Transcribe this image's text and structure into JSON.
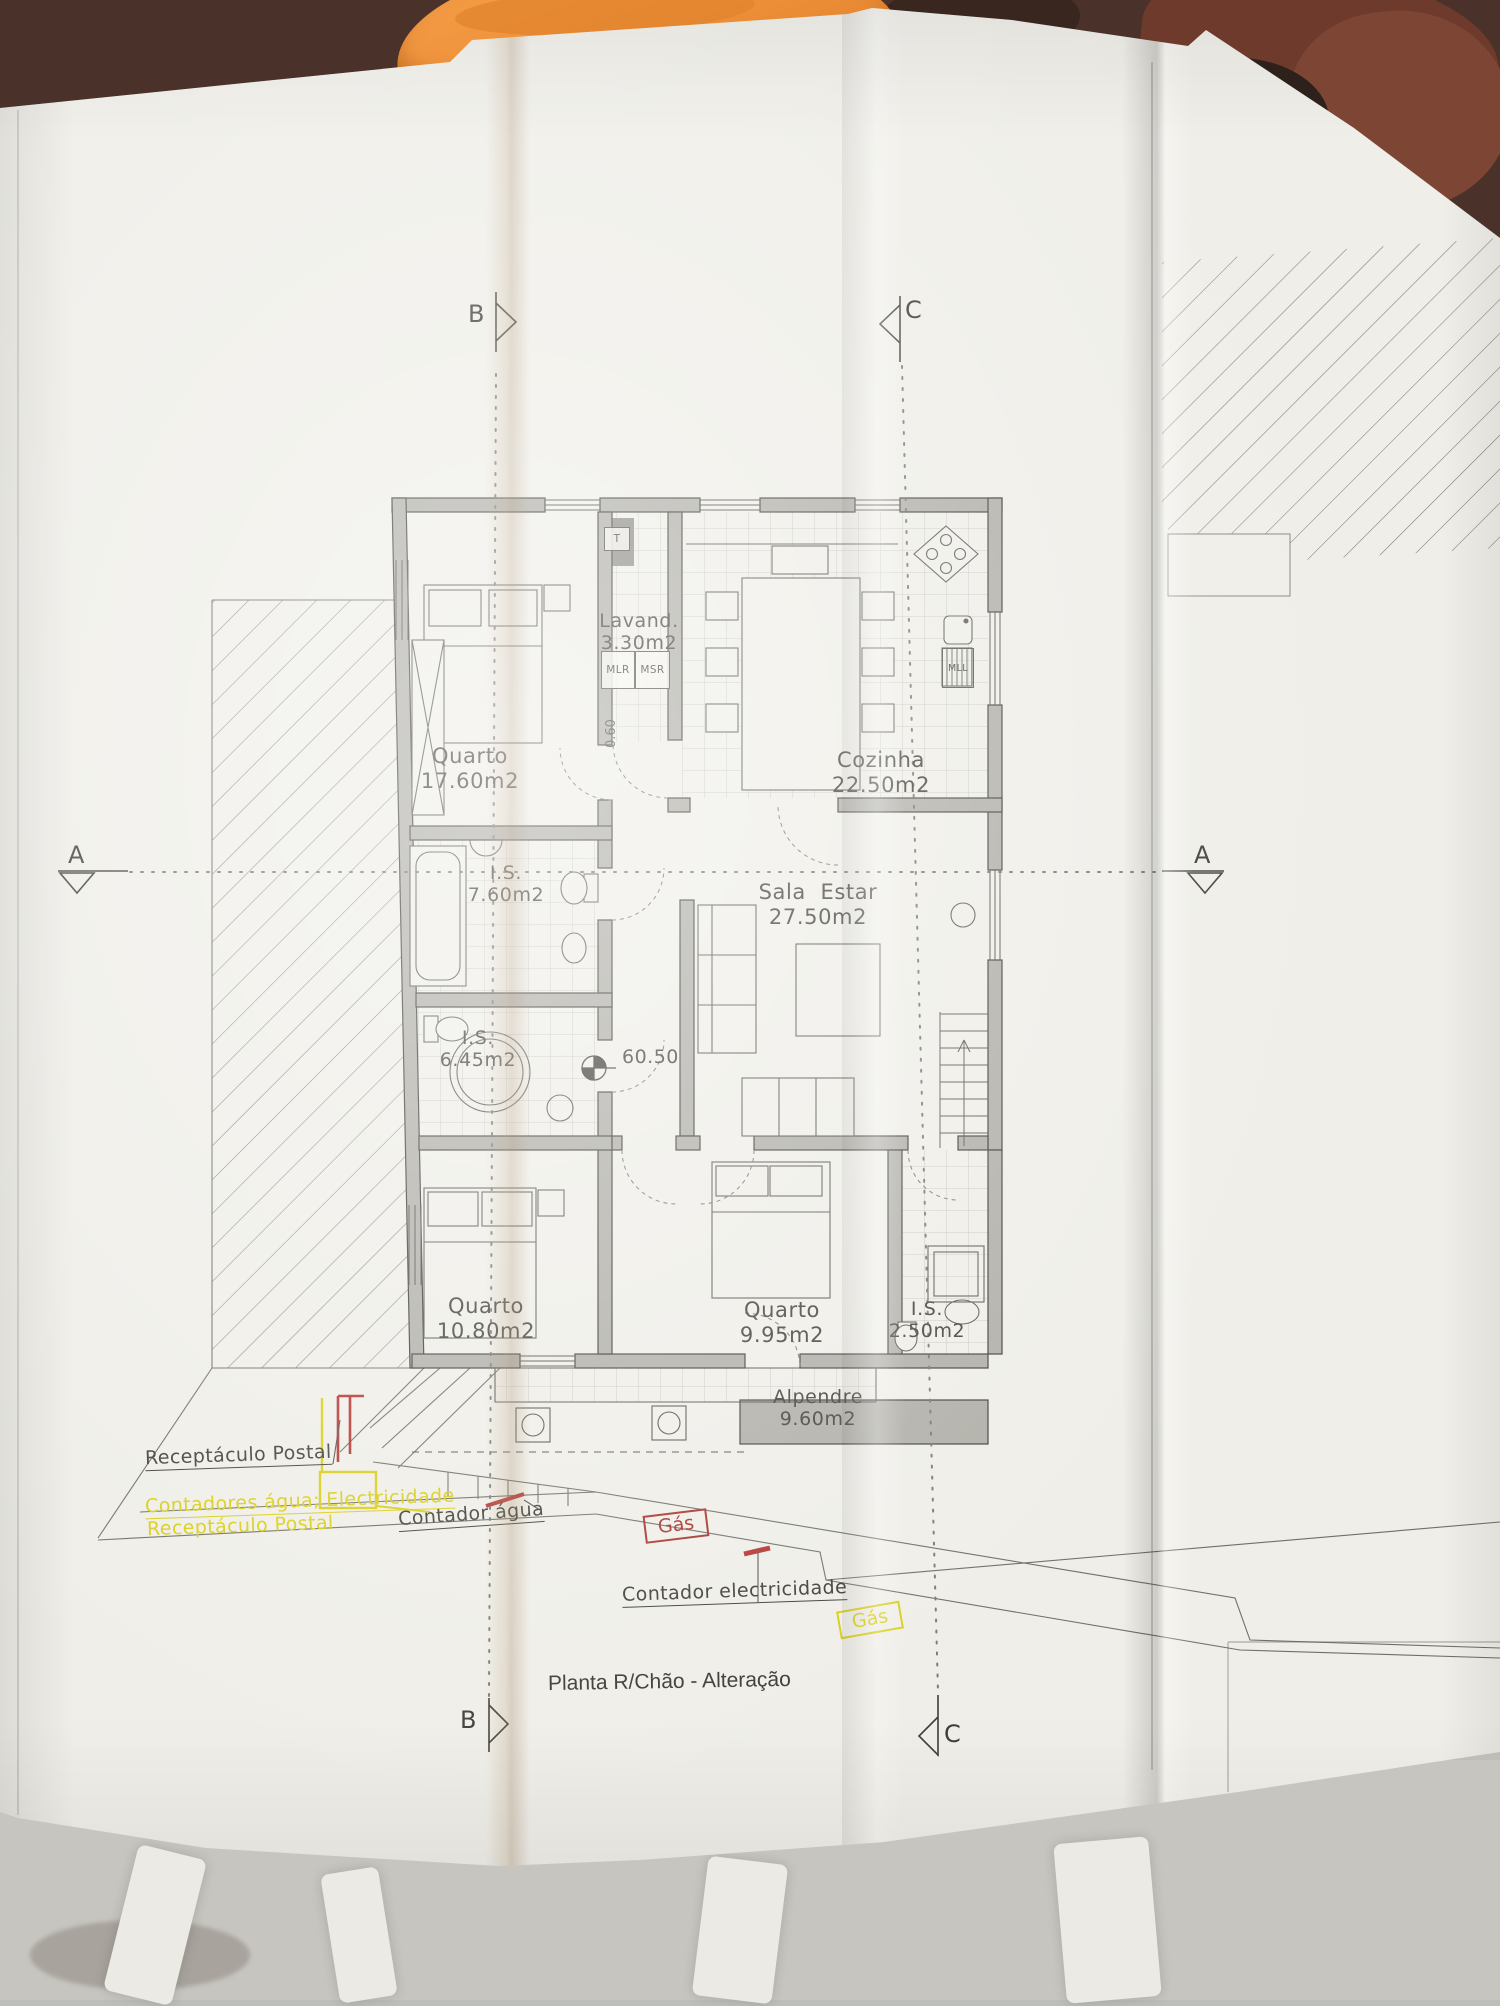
{
  "drawing": {
    "title": "Planta R/Chão - Alteração",
    "floor_level": "60.50",
    "step_level": "0.60"
  },
  "section_markers": {
    "b_top": "B",
    "c_top": "C",
    "a_left": "A",
    "a_right": "A",
    "b_bottom": "B",
    "c_bottom": "C"
  },
  "rooms": [
    {
      "name": "Quarto",
      "area": "17.60m2"
    },
    {
      "name": "Lavand.",
      "area": "3.30m2"
    },
    {
      "name": "Cozinha",
      "area": "22.50m2"
    },
    {
      "name": "I.S.",
      "area": "7.60m2"
    },
    {
      "name": "Sala  Estar",
      "area": "27.50m2"
    },
    {
      "name": "I.S.",
      "area": "6.45m2"
    },
    {
      "name": "Quarto",
      "area": "10.80m2"
    },
    {
      "name": "Quarto",
      "area": "9.95m2"
    },
    {
      "name": "I.S.",
      "area": "2.50m2"
    },
    {
      "name": "Alpendre",
      "area": "9.60m2"
    }
  ],
  "appliances": {
    "t": "T",
    "mlr": "MLR",
    "msr": "MSR",
    "mll": "MLL"
  },
  "annotations": {
    "receptaculo_postal": "Receptáculo Postal",
    "contadores": "Contadores água; Electricidade",
    "receptaculo_postal_2": "Receptáculo Postal",
    "contador_agua": "Contador água",
    "gas_1": "Gás",
    "contador_electricidade": "Contador electricidade",
    "gas_2": "Gás"
  },
  "colors": {
    "paper": "#efeee8",
    "ink": "#44433d",
    "wall_fill": "#b0afa8",
    "highlight_yellow": "#d9cd17",
    "highlight_red": "#a8332c",
    "towel_orange": "#ef913b",
    "background_brown": "#4a3129"
  }
}
